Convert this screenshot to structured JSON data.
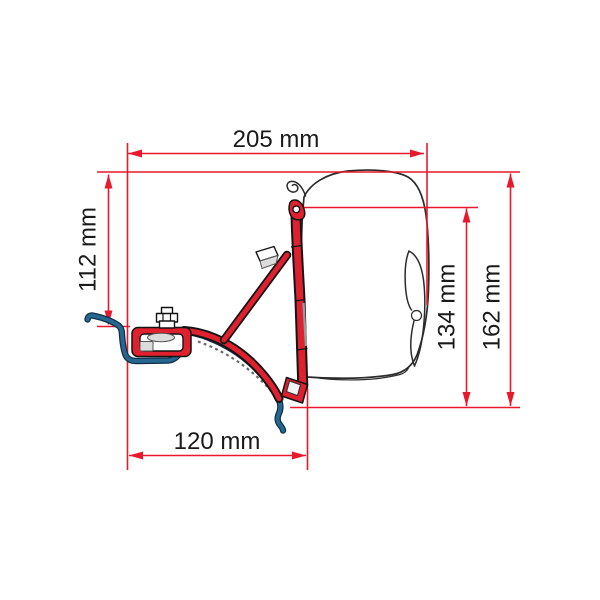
{
  "diagram": {
    "dimensions": {
      "total_width": {
        "label": "205 mm",
        "orientation": "horizontal"
      },
      "left_height": {
        "label": "112 mm",
        "orientation": "vertical"
      },
      "case_height": {
        "label": "134 mm",
        "orientation": "vertical"
      },
      "total_height": {
        "label": "162 mm",
        "orientation": "vertical"
      },
      "bottom_width": {
        "label": "120 mm",
        "orientation": "horizontal"
      }
    },
    "colors": {
      "dimension": "#e8192d",
      "bracket_red": "#df202e",
      "roof_blue": "#25678f",
      "outline_dark": "#2b2b2b",
      "background": "#ffffff",
      "text": "#1a1a1a"
    }
  }
}
